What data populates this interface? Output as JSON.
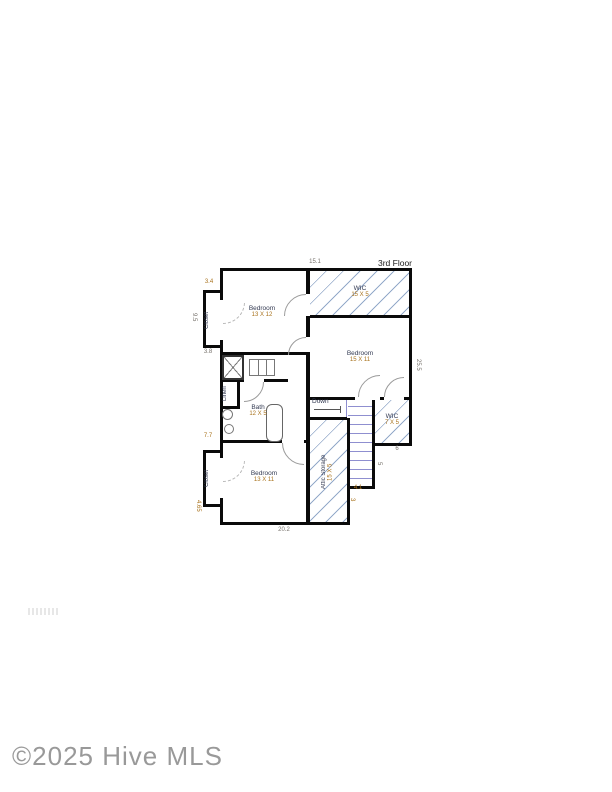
{
  "floor_label": "3rd Floor",
  "watermark": "©2025 Hive MLS",
  "rooms": {
    "bedroom1": {
      "name": "Bedroom",
      "size": "13 X 12"
    },
    "bedroom2": {
      "name": "Bedroom",
      "size": "15 X 11"
    },
    "bedroom3": {
      "name": "Bedroom",
      "size": "13 X 11"
    },
    "wic_top": {
      "name": "WIC",
      "size": "15 X 5"
    },
    "wic_right": {
      "name": "WIC",
      "size": "7 X 5"
    },
    "bath": {
      "name": "Bath",
      "size": "12 X 5"
    },
    "attic": {
      "name": "Attic Storage",
      "size": "15 X 5"
    },
    "closet_top": {
      "name": "Closet"
    },
    "closet_bottom": {
      "name": "Closet"
    },
    "linen": {
      "name": "Linen"
    },
    "stairs": {
      "label": "Down"
    }
  },
  "dimensions": {
    "top": "15.1",
    "bottom": "20.2",
    "right_side": "25.5",
    "left_closet_width": "3.4",
    "left_closet_height": "9.5",
    "left_mid": "3.8",
    "left_lower": "7.7",
    "left_bottom": "4.65",
    "wic_right_width": "6",
    "stair_side": "5",
    "step_width": "4.1",
    "step_height": "3"
  },
  "colors": {
    "wall": "#0a0a0a",
    "hatch_blue": "#7a94bc",
    "stair_tread": "#8f8fd0",
    "room_name": "#333a52",
    "room_size": "#a9731e",
    "dim_gray": "#76716b",
    "dim_orange": "#a9731e",
    "watermark_gray": "#8f8f8f"
  }
}
